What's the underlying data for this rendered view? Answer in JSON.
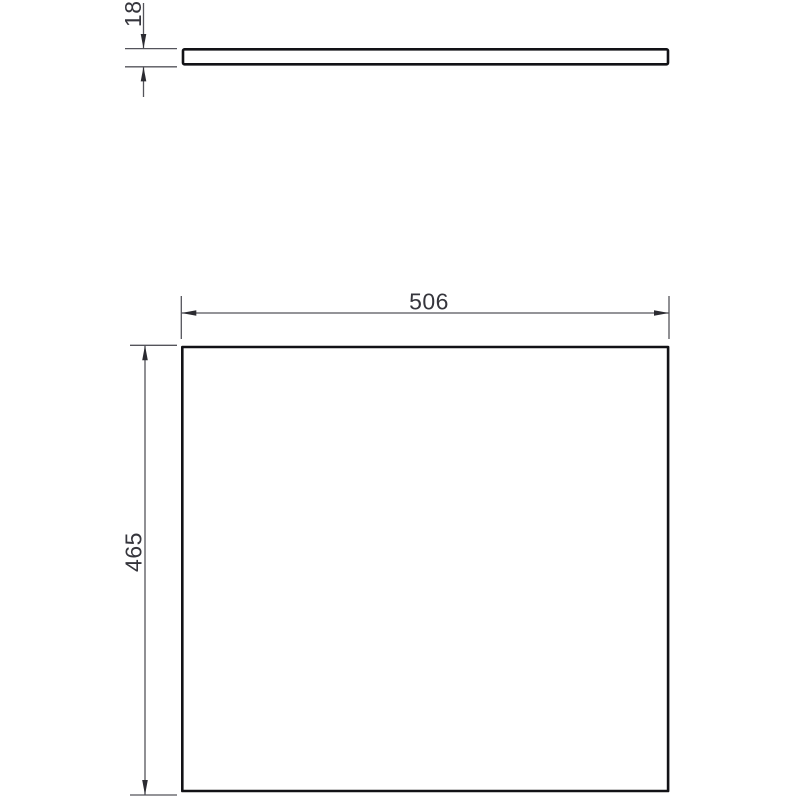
{
  "drawing": {
    "description": "Panel technical drawing with side (thickness) view and front view",
    "dimensions": {
      "thickness": {
        "value": "18"
      },
      "width": {
        "value": "506"
      },
      "height": {
        "value": "465"
      }
    },
    "colors": {
      "background": "#ffffff",
      "view_outline": "#121216",
      "dimension_line": "#54545b",
      "arrowhead": "#2b2b31",
      "dimension_text": "#35353c"
    }
  }
}
